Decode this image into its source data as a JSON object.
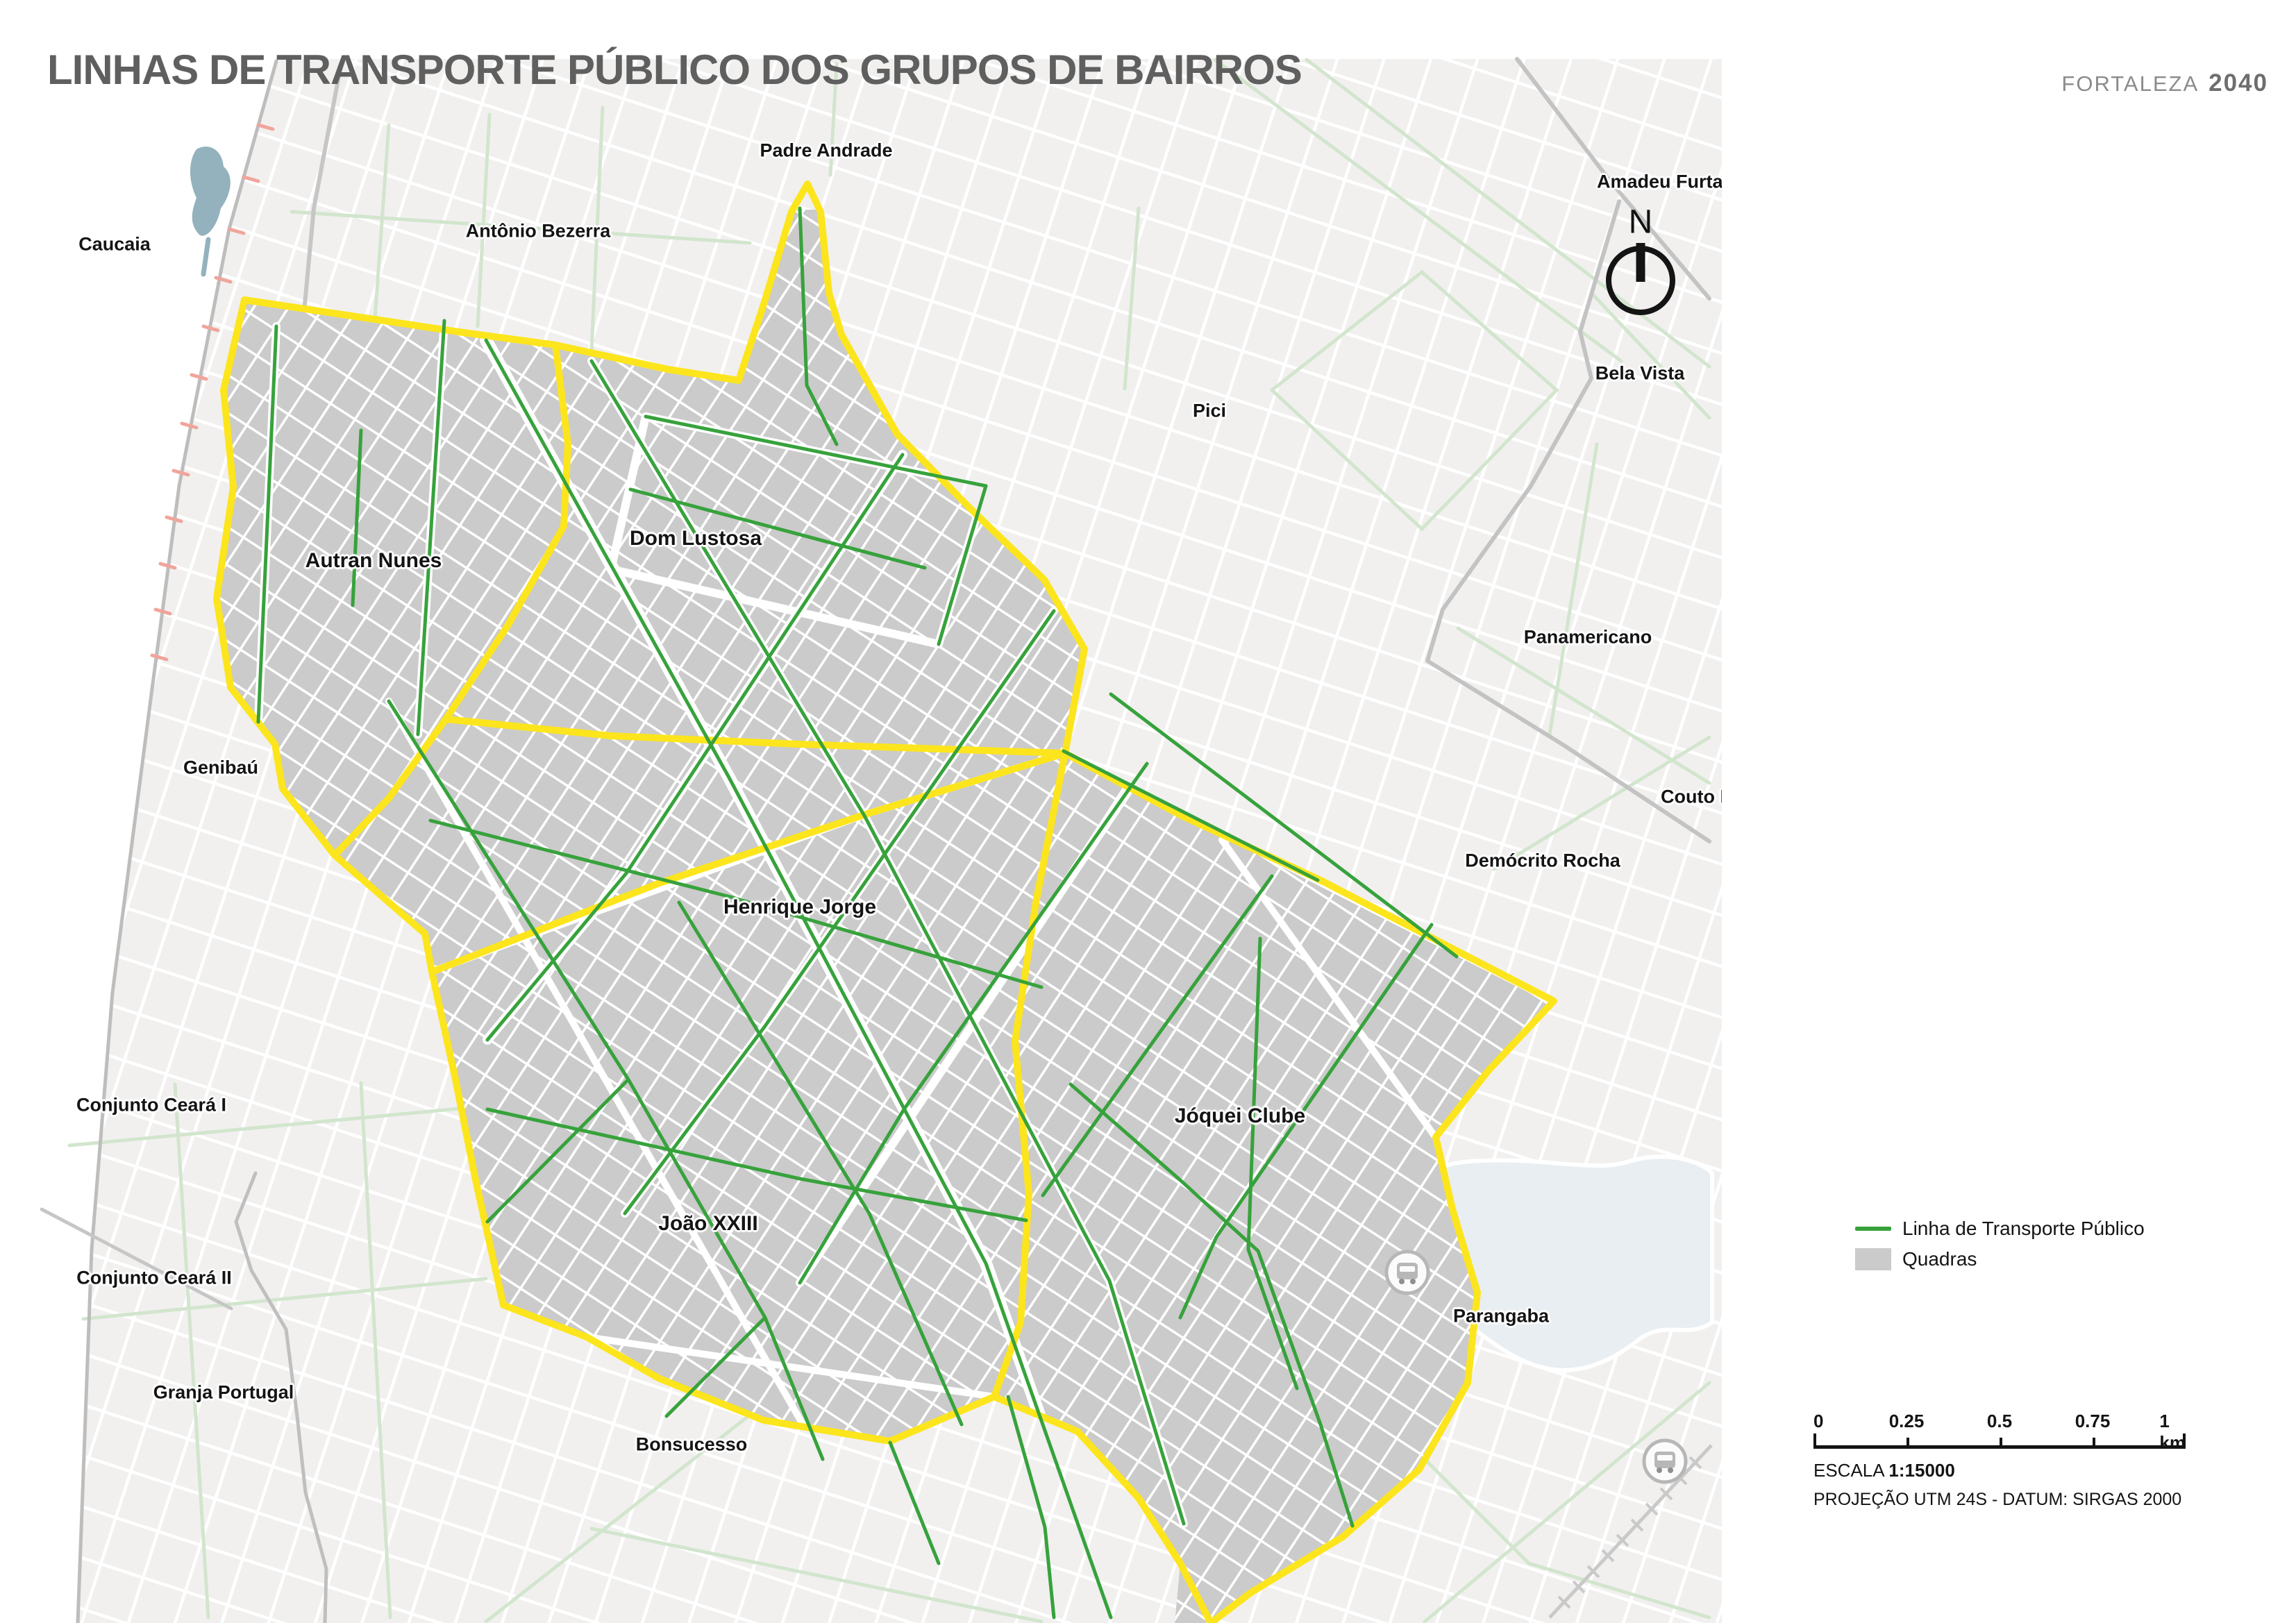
{
  "report": {
    "title": "LINHAS DE TRANSPORTE PÚBLICO DOS GRUPOS DE BAIRROS"
  },
  "brand": {
    "name": "FORTALEZA",
    "year": "2040"
  },
  "compass": {
    "label": "N"
  },
  "legend": {
    "items": [
      {
        "label": "Linha de Transporte Público",
        "swatch": "line",
        "color": "#37a23c"
      },
      {
        "label": "Quadras",
        "swatch": "area",
        "color": "#cbcbcb"
      }
    ]
  },
  "scalebar": {
    "ticks": [
      "0",
      "0.25",
      "0.5",
      "0.75",
      "1 km"
    ],
    "scale_prefix": "ESCALA",
    "scale_value": "1:15000",
    "projection": "PROJEÇÃO UTM 24S - DATUM: SIRGAS 2000"
  },
  "map": {
    "colors": {
      "transit_line_green": "#37a23c",
      "group_boundary_yellow": "#fce51c",
      "blocks_gray": "#cbcbcb",
      "water_blue": "#93b2bd",
      "lagoon_blue": "#e8eef1",
      "municipal_tick_salmon": "#f0a59b"
    },
    "labels": [
      {
        "text": "Caucaia"
      },
      {
        "text": "Antônio Bezerra"
      },
      {
        "text": "Padre Andrade"
      },
      {
        "text": "Amadeu Furta"
      },
      {
        "text": "Pici"
      },
      {
        "text": "Bela Vista"
      },
      {
        "text": "Panamericano"
      },
      {
        "text": "Couto Ferna"
      },
      {
        "text": "Demócrito Rocha"
      },
      {
        "text": "Autran Nunes"
      },
      {
        "text": "Dom Lustosa"
      },
      {
        "text": "Genibaú"
      },
      {
        "text": "Henrique Jorge"
      },
      {
        "text": "Jóquei Clube"
      },
      {
        "text": "João XXIII"
      },
      {
        "text": "Conjunto Ceará I"
      },
      {
        "text": "Conjunto Ceará II"
      },
      {
        "text": "Granja Portugal"
      },
      {
        "text": "Bonsucesso"
      },
      {
        "text": "Parangaba"
      }
    ]
  }
}
